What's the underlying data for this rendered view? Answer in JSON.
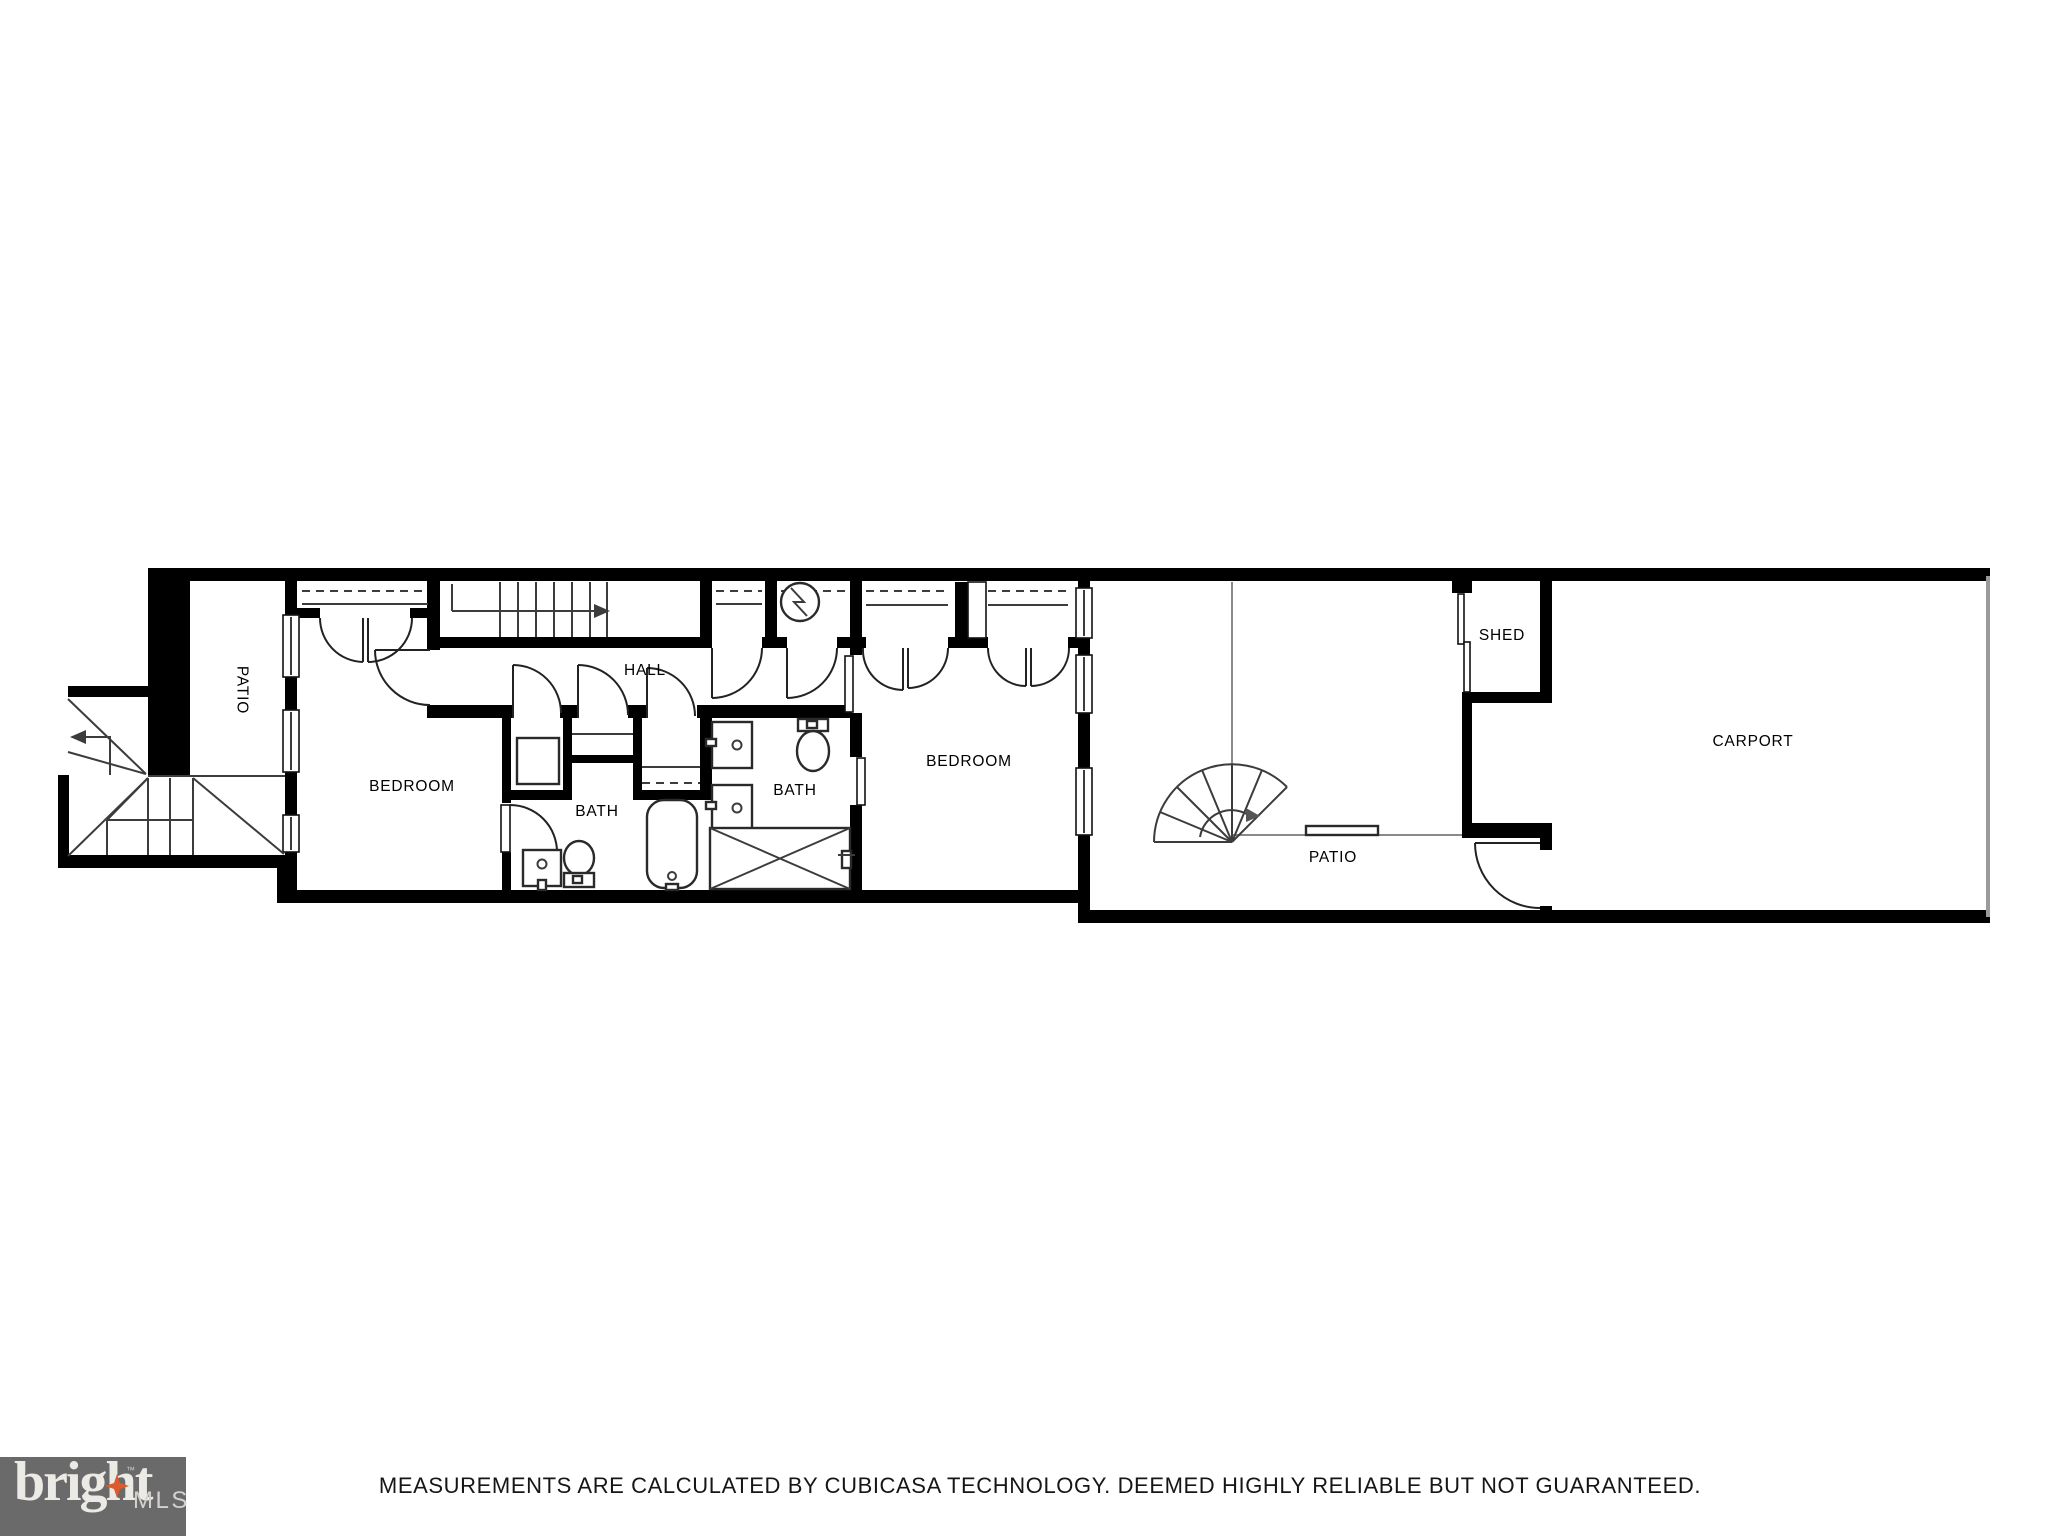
{
  "plan": {
    "type": "floorplan",
    "rooms": [
      {
        "id": "patio-1",
        "label": "PATIO",
        "orientation": "vertical"
      },
      {
        "id": "bedroom-1",
        "label": "BEDROOM",
        "orientation": "horizontal"
      },
      {
        "id": "bath-1",
        "label": "BATH",
        "orientation": "horizontal"
      },
      {
        "id": "hall",
        "label": "HALL",
        "orientation": "horizontal"
      },
      {
        "id": "bath-2",
        "label": "BATH",
        "orientation": "horizontal"
      },
      {
        "id": "bedroom-2",
        "label": "BEDROOM",
        "orientation": "horizontal"
      },
      {
        "id": "patio-2",
        "label": "PATIO",
        "orientation": "horizontal"
      },
      {
        "id": "shed",
        "label": "SHED",
        "orientation": "horizontal"
      },
      {
        "id": "carport",
        "label": "CARPORT",
        "orientation": "horizontal"
      }
    ],
    "colors": {
      "wall": "#000000",
      "thin_line": "#3c3c3c",
      "light_line": "#8a8a8a",
      "label": "#000000"
    }
  },
  "footer": {
    "disclaimer": "MEASUREMENTS ARE CALCULATED BY CUBICASA TECHNOLOGY. DEEMED HIGHLY RELIABLE BUT NOT GUARANTEED."
  },
  "brand": {
    "primary": "bright",
    "trademark": "™",
    "secondary": "MLS",
    "background": "#6B6A6B",
    "star_color": "#DC5A2D",
    "primary_color": "#ECEAE5",
    "secondary_color": "#D4D2CE"
  }
}
